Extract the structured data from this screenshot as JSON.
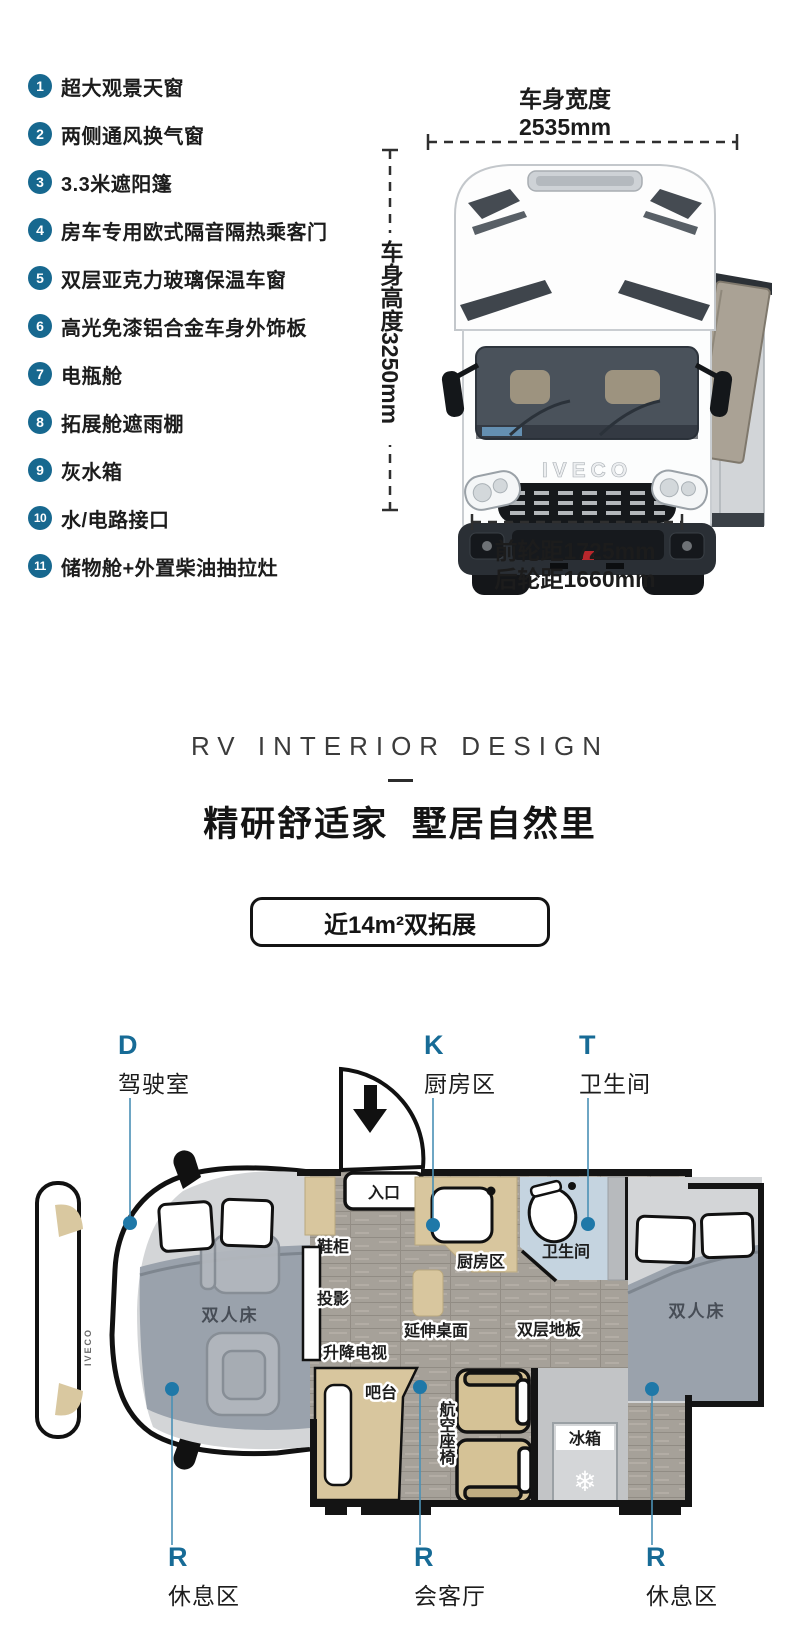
{
  "accent": "#17688f",
  "features": {
    "items": [
      {
        "num": "1",
        "text": "超大观景天窗"
      },
      {
        "num": "2",
        "text": "两侧通风换气窗"
      },
      {
        "num": "3",
        "text": "3.3米遮阳篷"
      },
      {
        "num": "4",
        "text": "房车专用欧式隔音隔热乘客门"
      },
      {
        "num": "5",
        "text": "双层亚克力玻璃保温车窗"
      },
      {
        "num": "6",
        "text": "高光免漆铝合金车身外饰板"
      },
      {
        "num": "7",
        "text": "电瓶舱"
      },
      {
        "num": "8",
        "text": "拓展舱遮雨棚"
      },
      {
        "num": "9",
        "text": "灰水箱"
      },
      {
        "num": "10",
        "text": "水/电路接口"
      },
      {
        "num": "11",
        "text": "储物舱+外置柴油抽拉灶"
      }
    ]
  },
  "vehicle": {
    "width_label": "车身宽度",
    "width_value": "2535mm",
    "height_label": "车身高度3250mm",
    "front_track": "前轮距1725mm",
    "rear_track": "后轮距1660mm",
    "brand": "IVECO"
  },
  "interior": {
    "eyebrow": "RV INTERIOR DESIGN",
    "title": "精研舒适家  墅居自然里",
    "badge": "近14m²双拓展"
  },
  "zones": {
    "top": [
      {
        "letter": "D",
        "name": "驾驶室"
      },
      {
        "letter": "K",
        "name": "厨房区"
      },
      {
        "letter": "T",
        "name": "卫生间"
      }
    ],
    "bottom": [
      {
        "letter": "R",
        "name": "休息区"
      },
      {
        "letter": "R",
        "name": "会客厅"
      },
      {
        "letter": "R",
        "name": "休息区"
      }
    ]
  },
  "floorplan": {
    "labels": {
      "entrance": "入口",
      "shoe_cabinet": "鞋柜",
      "projector": "投影",
      "lift_tv": "升降电视",
      "double_bed": "双人床",
      "kitchen": "厨房区",
      "bathroom": "卫生间",
      "ext_table": "延伸桌面",
      "double_floor": "双层地板",
      "bar": "吧台",
      "aviation_seats": "航空座椅",
      "fridge": "冰箱",
      "snowflake": "❄"
    }
  }
}
